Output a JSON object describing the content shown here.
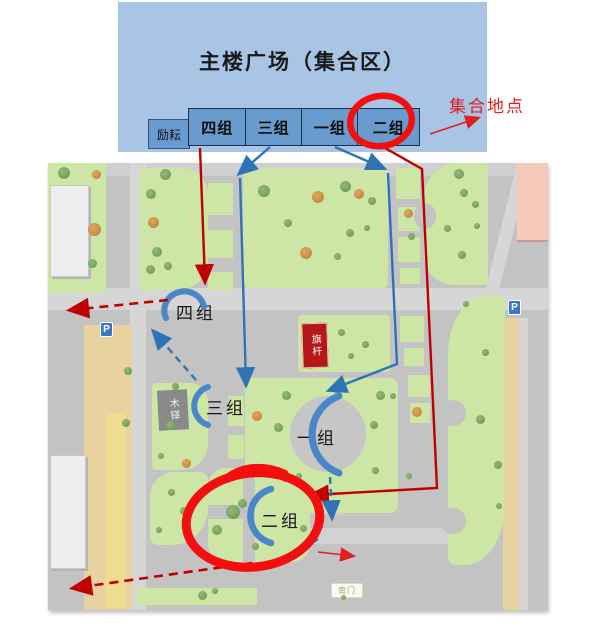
{
  "header": {
    "title": "主楼广场（集合区）",
    "building_label": "励耘",
    "groups": [
      "四组",
      "三组",
      "一组",
      "二组"
    ]
  },
  "callouts": {
    "assembly": "集合地点",
    "photo": "拍照地点"
  },
  "map": {
    "group_labels": {
      "g4": "四组",
      "g3": "三组",
      "g1": "一组",
      "g2": "二组"
    },
    "flagpole": "旗杆",
    "bell": "木铎",
    "south_gate": "南门",
    "parking_sign": "P"
  },
  "colors": {
    "header_bg": "#a9c5e6",
    "group_box_bg": "#6a9bce",
    "map_bg": "#c3c3c3",
    "grass": "#cde6a5",
    "route_red": "#c00000",
    "route_blue": "#2e74b5",
    "highlight_red": "#f50e0e",
    "callout_red": "#e02020",
    "tan_path": "#e8d3a0",
    "pink_building": "#f6cabb",
    "flag_red": "#b51818",
    "bell_gray": "#8a8a8a"
  }
}
